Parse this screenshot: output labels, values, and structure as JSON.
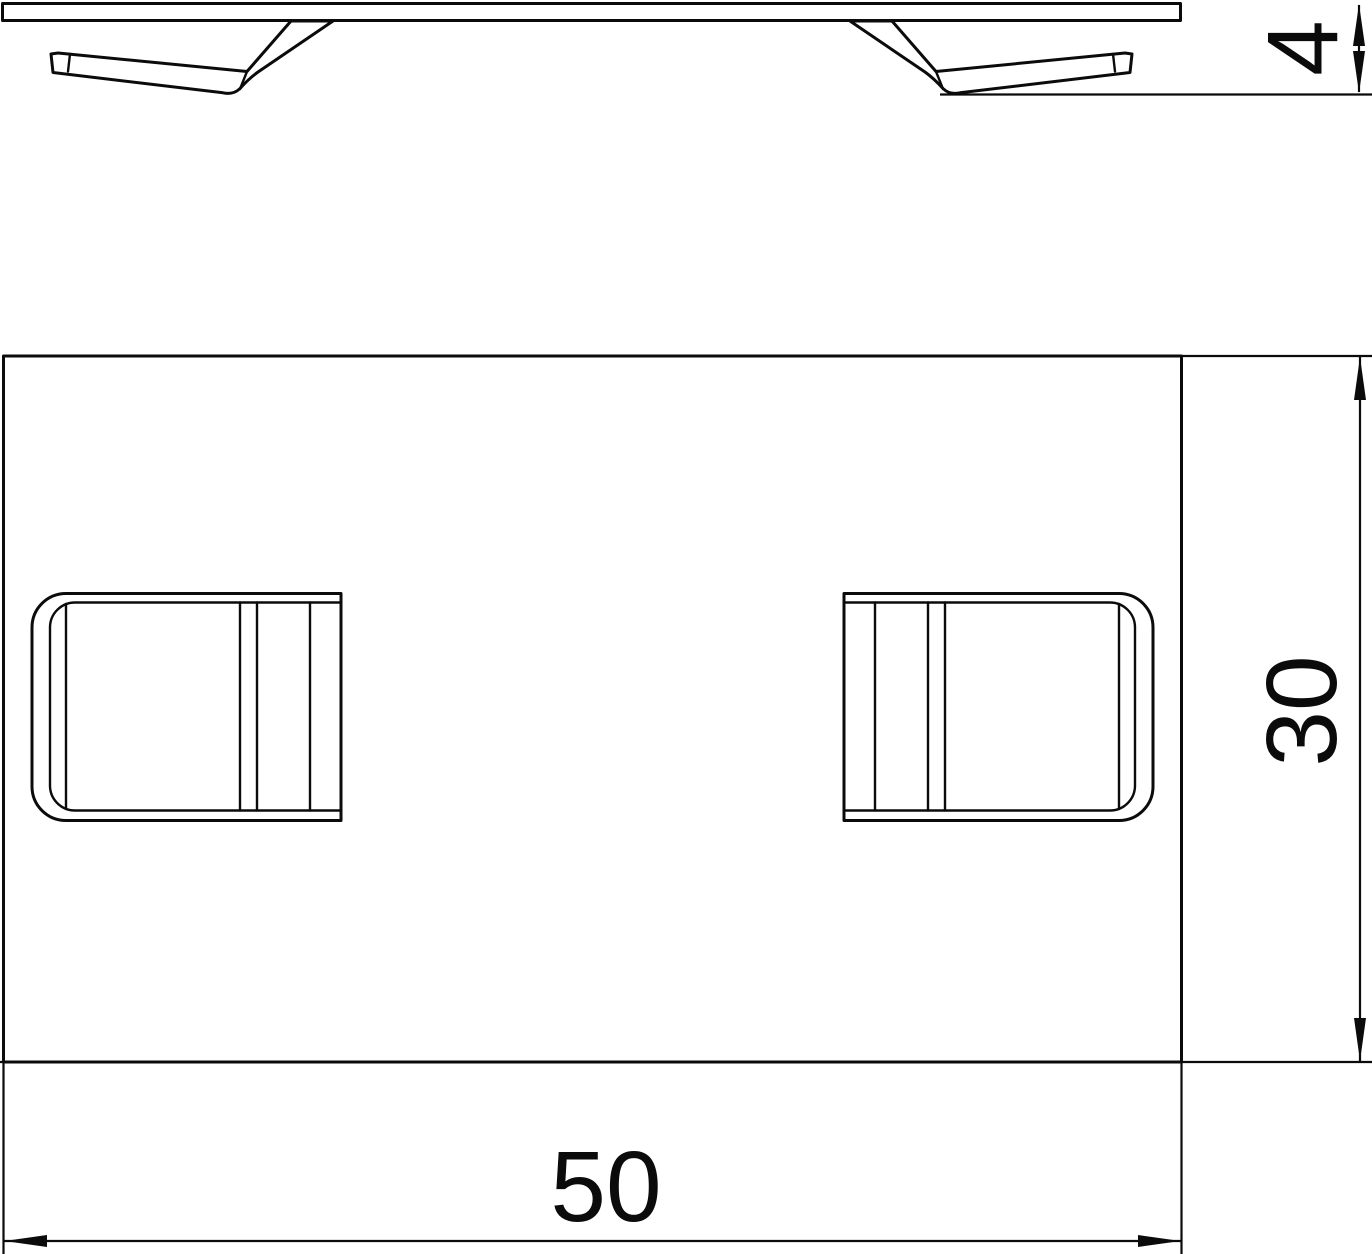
{
  "drawing": {
    "type": "technical-dimension-drawing",
    "background_color": "#ffffff",
    "line_color": "#0b0b0b",
    "views": {
      "side_view": {
        "name": "side-profile-view"
      },
      "plan_view": {
        "name": "top-plan-view"
      }
    },
    "dimensions": {
      "thickness": {
        "label": "4",
        "orientation": "vertical"
      },
      "height": {
        "label": "30",
        "orientation": "vertical"
      },
      "width": {
        "label": "50",
        "orientation": "horizontal"
      }
    }
  }
}
